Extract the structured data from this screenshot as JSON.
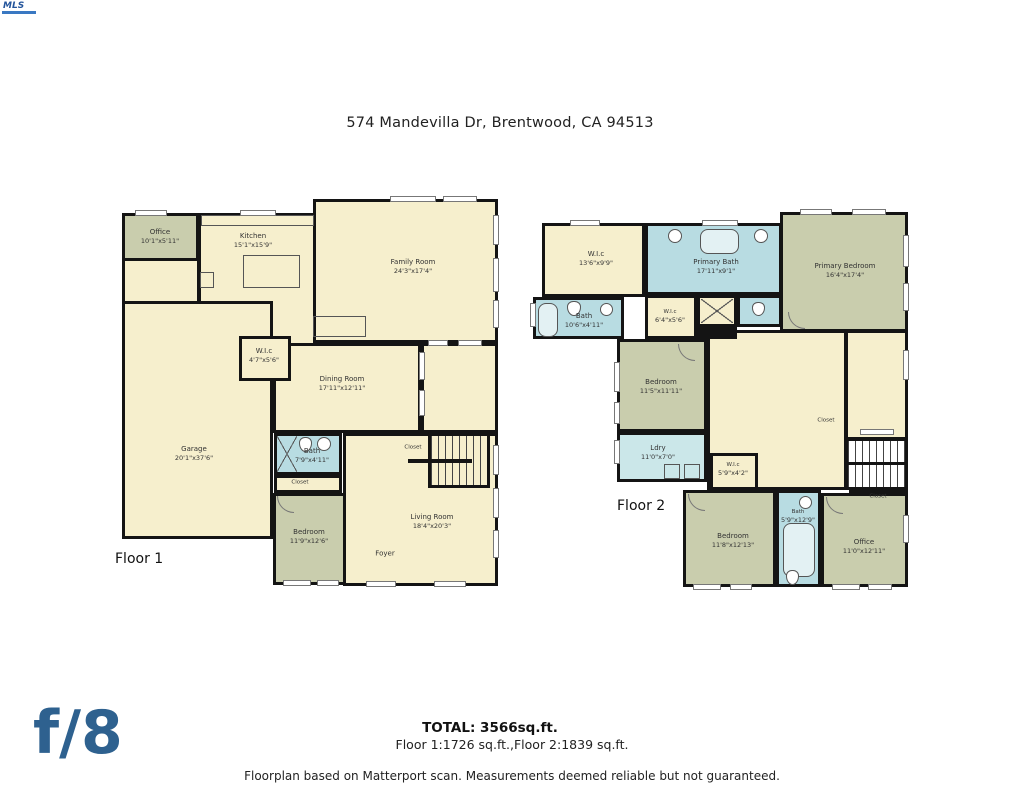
{
  "colors": {
    "wall": "#141414",
    "room_cream": "#f6efcd",
    "room_sage": "#c9cdad",
    "room_bath_blue": "#b8dce2",
    "room_laundry_blue": "#cbe7e9",
    "brand_blue": "#2e618f"
  },
  "header": {
    "logo_text": "MLS",
    "title": "574 Mandevilla Dr, Brentwood, CA 94513"
  },
  "floor1": {
    "label": "Floor 1",
    "rooms": {
      "office": {
        "name": "Office",
        "dims": "10'1\"x5'11\""
      },
      "kitchen": {
        "name": "Kitchen",
        "dims": "15'1\"x15'9\""
      },
      "family": {
        "name": "Family Room",
        "dims": "24'3\"x17'4\""
      },
      "wic": {
        "name": "W.I.c",
        "dims": "4'7\"x5'6\""
      },
      "dining": {
        "name": "Dining Room",
        "dims": "17'11\"x12'11\""
      },
      "garage": {
        "name": "Garage",
        "dims": "20'1\"x37'6\""
      },
      "bath": {
        "name": "Bath",
        "dims": "7'9\"x4'11\""
      },
      "closet_bath": {
        "name": "Closet",
        "dims": ""
      },
      "closet_stairs": {
        "name": "Closet",
        "dims": ""
      },
      "bedroom": {
        "name": "Bedroom",
        "dims": "11'9\"x12'6\""
      },
      "living": {
        "name": "Living Room",
        "dims": "18'4\"x20'3\""
      },
      "foyer": {
        "name": "Foyer",
        "dims": ""
      }
    }
  },
  "floor2": {
    "label": "Floor 2",
    "rooms": {
      "wic_primary": {
        "name": "W.I.c",
        "dims": "13'6\"x9'9\""
      },
      "primary_bath": {
        "name": "Primary Bath",
        "dims": "17'11\"x9'1\""
      },
      "primary_bedroom": {
        "name": "Primary Bedroom",
        "dims": "16'4\"x17'4\""
      },
      "bath_hall": {
        "name": "Bath",
        "dims": "10'6\"x4'11\""
      },
      "wic_small": {
        "name": "W.I.c",
        "dims": "6'4\"x5'6\""
      },
      "bedroom_mid": {
        "name": "Bedroom",
        "dims": "11'5\"x11'11\""
      },
      "laundry": {
        "name": "Ldry",
        "dims": "11'0\"x7'0\""
      },
      "wic_hall": {
        "name": "W.I.c",
        "dims": "5'9\"x4'2\""
      },
      "closet_landing": {
        "name": "Closet",
        "dims": ""
      },
      "closet_stairs": {
        "name": "Closet",
        "dims": ""
      },
      "bedroom_front": {
        "name": "Bedroom",
        "dims": "11'8\"x12'13\""
      },
      "bath_front": {
        "name": "Bath",
        "dims": "5'9\"x12'9\""
      },
      "office": {
        "name": "Office",
        "dims": "11'0\"x12'11\""
      }
    }
  },
  "footer": {
    "total": "TOTAL: 3566sq.ft.",
    "floor_breakdown": "Floor 1:1726 sq.ft.,Floor 2:1839 sq.ft.",
    "disclaimer": "Floorplan based on Matterport scan. Measurements deemed reliable but not guaranteed.",
    "brand": "f/8"
  }
}
